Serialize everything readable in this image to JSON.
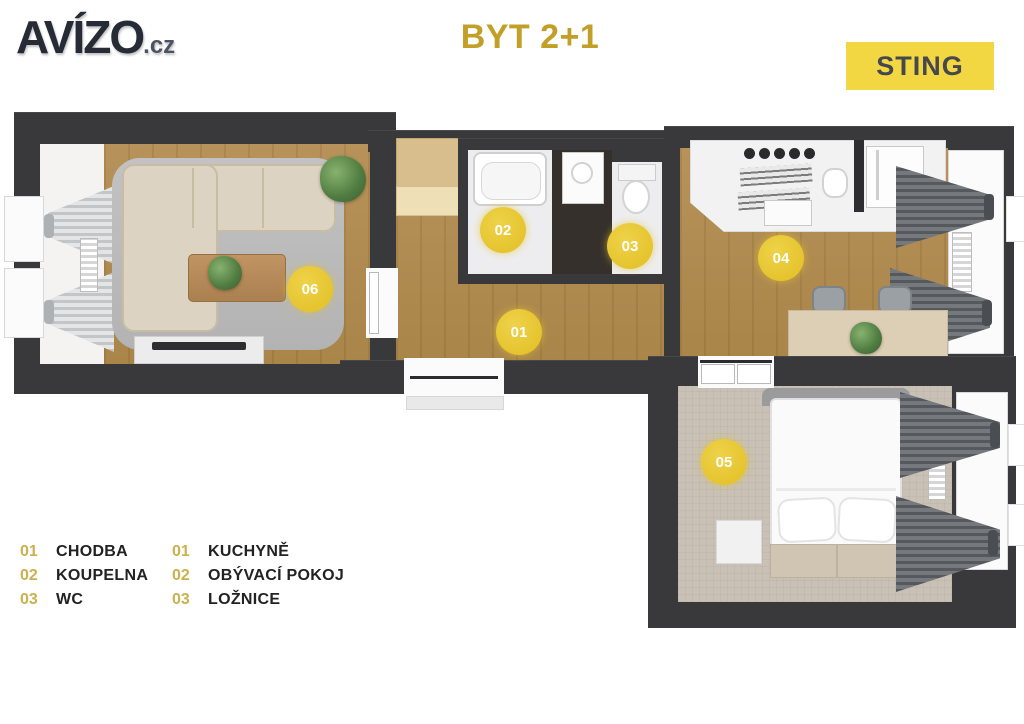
{
  "header": {
    "logo_text": "AVÍZO",
    "logo_suffix": ".cz",
    "title": "BYT 2+1",
    "badge": "STING"
  },
  "colors": {
    "title_gold": "#c2a028",
    "badge_yellow": "#f2d743",
    "marker_yellow": "#e5c42e",
    "wall_dark": "#39393b",
    "wood_floor": "#b08b4f",
    "carpet_beige": "#c9c1b5"
  },
  "plan": {
    "markers": [
      {
        "id": "01"
      },
      {
        "id": "02"
      },
      {
        "id": "03"
      },
      {
        "id": "04"
      },
      {
        "id": "05"
      },
      {
        "id": "06"
      }
    ]
  },
  "legend": {
    "col1": [
      {
        "num": "01",
        "label": "CHODBA"
      },
      {
        "num": "02",
        "label": "KOUPELNA"
      },
      {
        "num": "03",
        "label": "WC"
      }
    ],
    "col2": [
      {
        "num": "01",
        "label": "KUCHYNĚ"
      },
      {
        "num": "02",
        "label": "OBÝVACÍ POKOJ"
      },
      {
        "num": "03",
        "label": "LOŽNICE"
      }
    ]
  }
}
